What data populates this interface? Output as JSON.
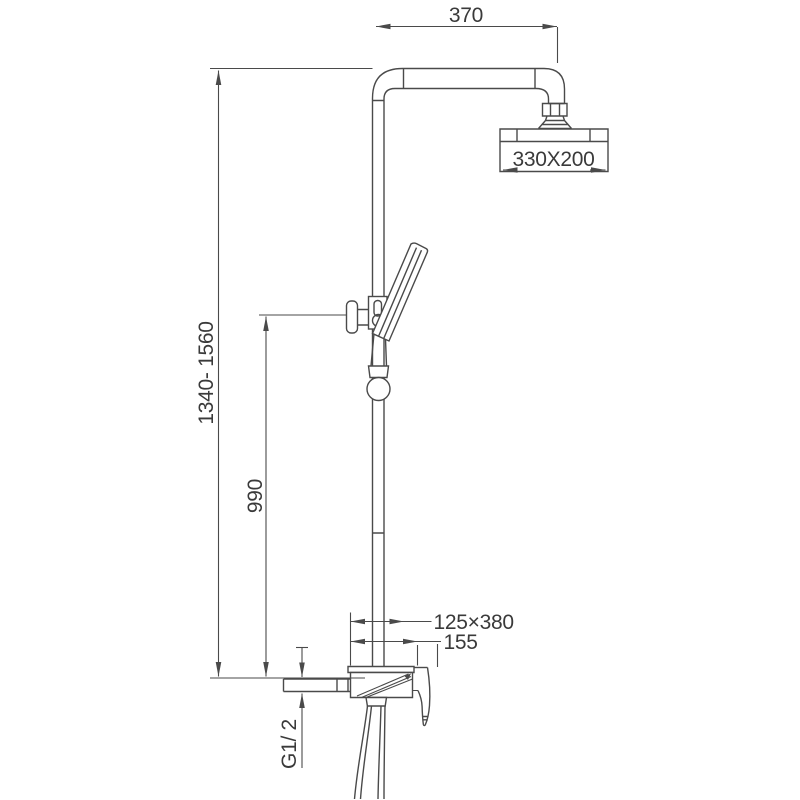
{
  "drawing": {
    "background_color": "#ffffff",
    "line_color": "#4a4a4a",
    "text_color": "#3a3a3a",
    "dimensions": {
      "arm_reach_mm": "370",
      "shower_head_size_mm": "330X200",
      "total_height_range_mm": "1340- 1560",
      "hand_shower_height_mm": "990",
      "mixer_size_mm": "125×380",
      "mixer_reach_mm": "155",
      "inlet_thread": "G1/ 2"
    }
  }
}
